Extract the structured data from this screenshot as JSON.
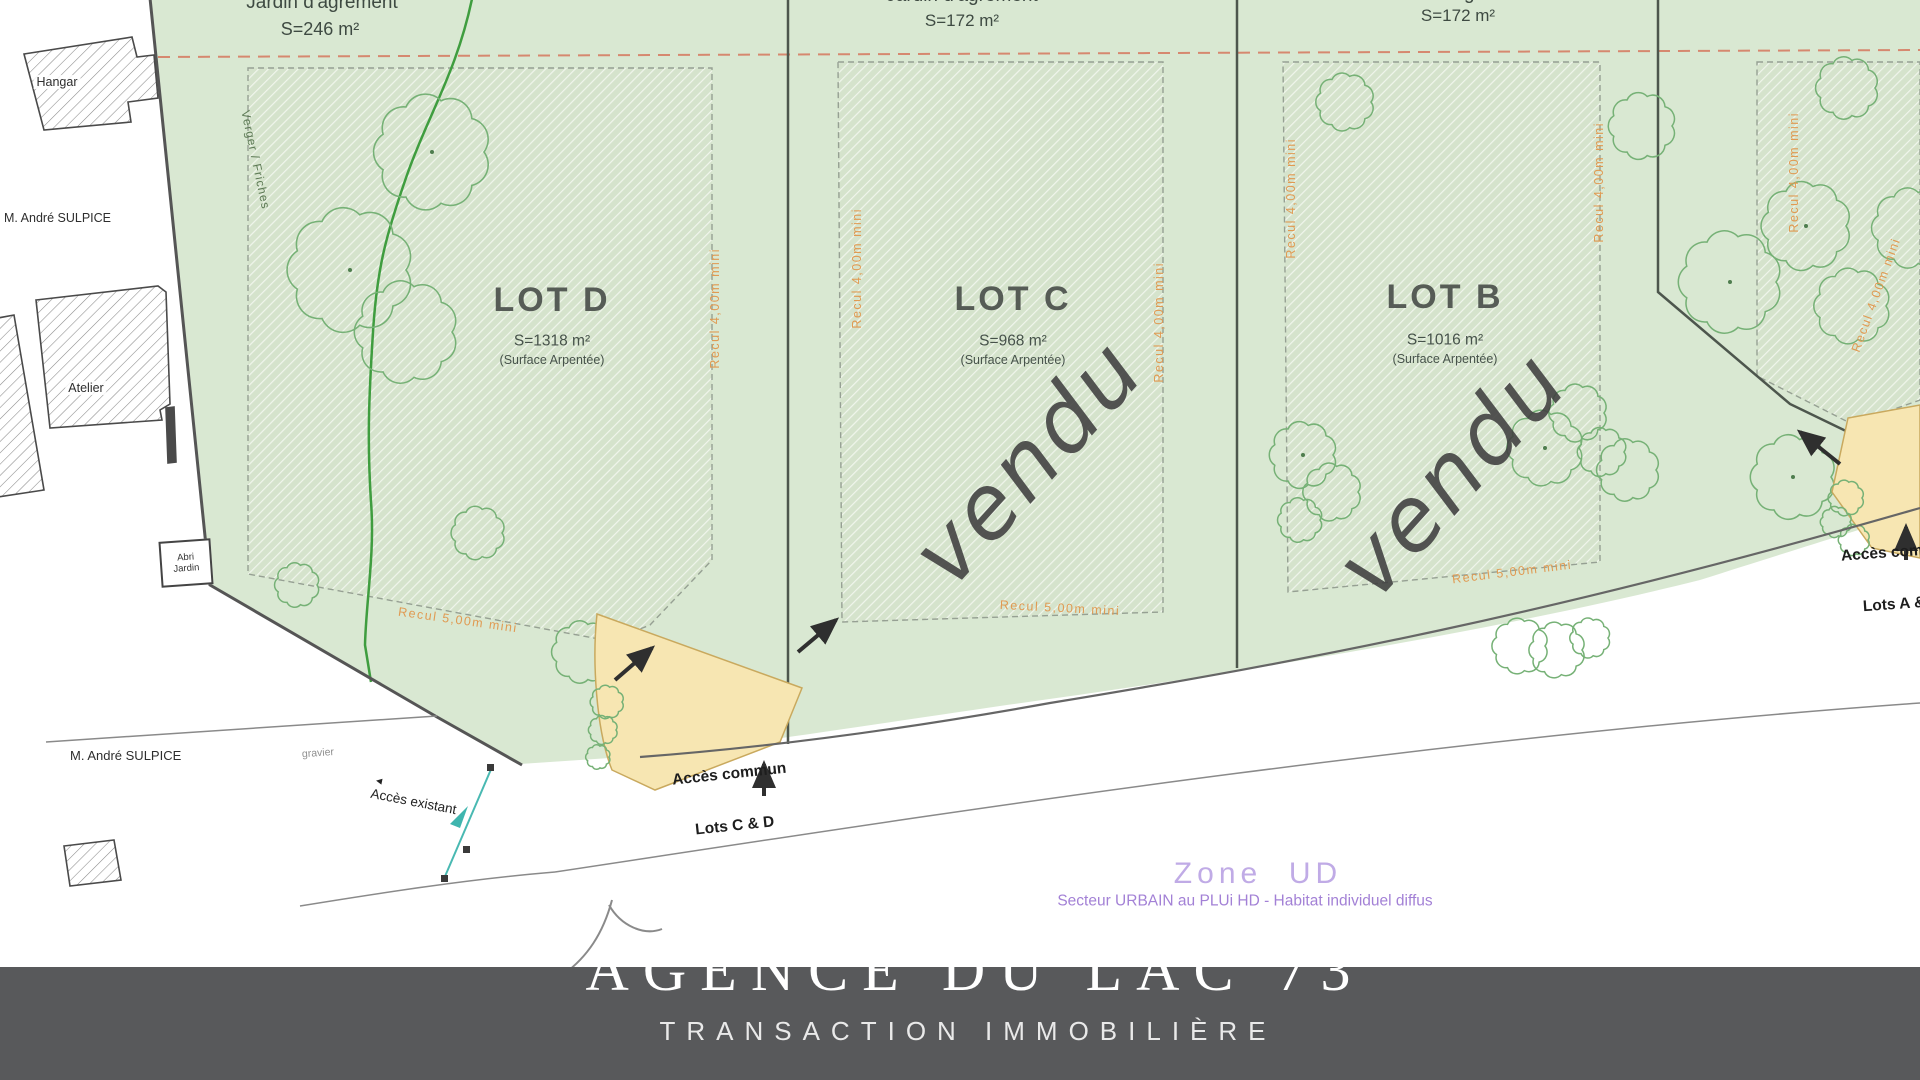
{
  "gardens": {
    "d": {
      "line1": "Jardin d'agrément",
      "line2": "S=246 m²"
    },
    "c": {
      "line1": "Jardin d'agrément",
      "line2": "S=172 m²"
    },
    "b": {
      "line1": "Jardin d'agrément",
      "line2": "S=172 m²"
    }
  },
  "lots": [
    {
      "name": "LOT D",
      "surface": "S=1318 m²",
      "note": "(Surface Arpentée)"
    },
    {
      "name": "LOT C",
      "surface": "S=968 m²",
      "note": "(Surface Arpentée)",
      "status": "vendu"
    },
    {
      "name": "LOT B",
      "surface": "S=1016 m²",
      "note": "(Surface Arpentée)",
      "status": "vendu"
    }
  ],
  "reculs": {
    "side": "Recul 4,00m mini",
    "front": "Recul 5,00m mini"
  },
  "neighbors": {
    "hangar": "Hangar",
    "owner_top": "M. André SULPICE",
    "atelier": "Atelier",
    "abri_line1": "Abri",
    "abri_line2": "Jardin",
    "owner_bottom": "M. André SULPICE",
    "gravier": "gravier",
    "hedge_label": "Verger / Friches"
  },
  "access": {
    "existing": "Accès existant",
    "common_cd_line1": "Accès commun",
    "common_cd_line2": "Lots C & D",
    "common_ab_line1": "Accès commun",
    "common_ab_line2": "Lots A & B"
  },
  "zone": {
    "title": "Zone  UD",
    "subtitle": "Secteur URBAIN au PLUi HD - Habitat individuel diffus"
  },
  "banner": {
    "title": "AGENCE DU LAC 73",
    "subtitle": "TRANSACTION IMMOBILIÈRE"
  },
  "icons": {
    "left_arrow": "◄"
  },
  "colors": {
    "green_base": "#d9e8d2",
    "hatch_line": "#f0f5ec",
    "yellow": "#f7e6b2",
    "recul_orange": "#e09a52",
    "purple_title": "#c0abe6",
    "purple_sub": "#a381d6",
    "banner_bg": "#58595b",
    "red_limit_line": "#d6886f",
    "teal": "#49b9b2"
  }
}
